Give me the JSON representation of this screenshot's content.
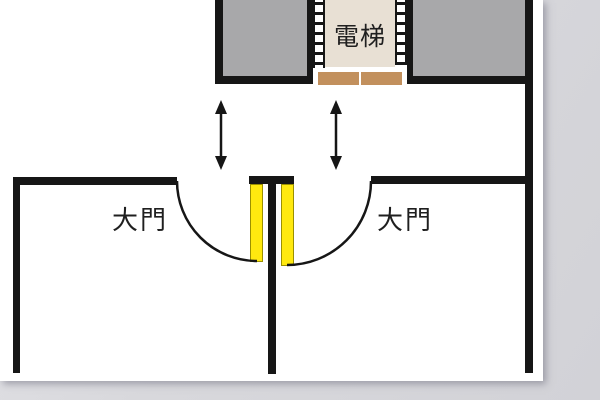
{
  "page": {
    "background": "#d8d8dc",
    "paper": "#ffffff"
  },
  "colors": {
    "wall": "#161616",
    "room_fill": "#a8a8aa",
    "cab_fill": "#e8e0d4",
    "elevator_door": "#c2905d",
    "door_panel": "#ffe90f",
    "door_panel_edge": "#9b9000",
    "text": "#1f1f1f"
  },
  "labels": {
    "elevator": "電梯",
    "door_left": "大門",
    "door_right": "大門"
  },
  "icons": {
    "arrow_left": "up-down-arrow",
    "arrow_right": "up-down-arrow"
  }
}
